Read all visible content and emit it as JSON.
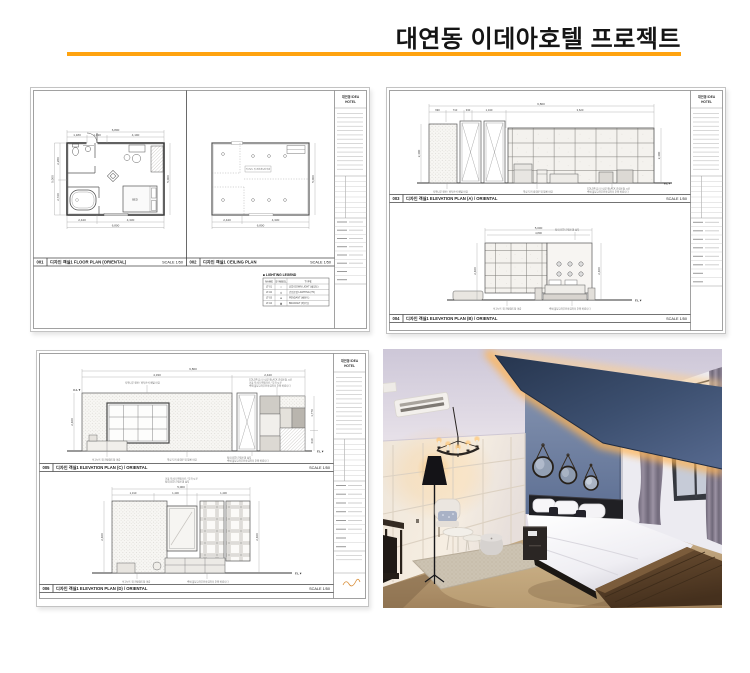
{
  "header": {
    "title": "대연동 이데아호텔 프로젝트",
    "accent_color": "#FFA30F"
  },
  "marks": {
    "fl": "F.L▼",
    "cl": "C.L▼"
  },
  "tb": {
    "p1": "대연동 IDEA",
    "p2": "HOTEL"
  },
  "bars": {
    "b1": {
      "no": "001",
      "label": "디자인 객실1 FLOOR PLAN (ORIENTAL)",
      "scale": "SCALE 1/50"
    },
    "b2": {
      "no": "002",
      "label": "디자인 객실1 CEILING PLAN",
      "scale": "SCALE 1/50"
    },
    "b3": {
      "no": "003",
      "label": "디자인 객실1 ELEVATION PLAN (A) / ORIENTAL",
      "scale": "SCALE 1/50"
    },
    "b4": {
      "no": "004",
      "label": "디자인 객실1 ELEVATION PLAN (B) / ORIENTAL",
      "scale": "SCALE 1/50"
    },
    "b5": {
      "no": "005",
      "label": "디자인 객실1 ELEVATION PLAN (C) / ORIENTAL",
      "scale": "SCALE 1/50"
    },
    "b6": {
      "no": "006",
      "label": "디자인 객실1 ELEVATION PLAN (D) / ORIENTAL",
      "scale": "SCALE 1/50"
    }
  },
  "legend": {
    "title": "■ LIGHTING LEGEND",
    "cols": [
      "NAME",
      "SYMBOL",
      "TYPE"
    ],
    "rows": [
      [
        "LT-01",
        "✧",
        "LED DOWN LIGHT (매입등)"
      ],
      [
        "LT-02",
        "◎",
        "간접조명 LIGHTING (T5)"
      ],
      [
        "LT-03",
        "⊕",
        "PENDANT (펜던트)"
      ],
      [
        "LT-04",
        "▣",
        "BRACKET (벽부등)"
      ]
    ]
  },
  "notes": {
    "n1": "석고보드 위 친환경도장 마감",
    "n2": "자작나무 합판 / 바둑판식 배열 마감",
    "n3": "COLOR 유리 / 내부 BLACK 간접조명 시공",
    "n4": "벽체 몰딩교차부분마감처리 주의 바랍니다",
    "n5": "객실 도어 방화문 위 필름 마감",
    "n6": "침대 LED 간접조명 설치",
    "n7": "거울 모서리 면취가공 / 부착 시공"
  },
  "s1": {
    "fp": {
      "tt": "6,800",
      "t1": "1,180",
      "t2": "1,430",
      "t3": "4,190",
      "b1": "2,440",
      "b2": "4,330",
      "bt": "6,800",
      "l1": "2,280",
      "l2": "2,720",
      "lt": "5,000",
      "rt": "5,000",
      "bed": "BED"
    },
    "cp": {
      "b1": "2,440",
      "b2": "4,330",
      "bt": "6,800",
      "rt": "5,000"
    }
  },
  "s2": {
    "ea": {
      "tt": "6,800",
      "s1": "690",
      "s2": "710",
      "s3": "330",
      "s4": "1,340",
      "s5": "3,620",
      "lh": "2,400",
      "rh": "2,400"
    },
    "eb": {
      "tt": "5,000",
      "t2": "4,800",
      "lh": "2,400",
      "rh": "2,400"
    }
  },
  "s3": {
    "ec": {
      "tt": "6,800",
      "s1": "4,330",
      "s2": "2,440",
      "lh": "2,400",
      "r1": "1,770",
      "r2": "630"
    },
    "ed": {
      "tt": "5,000",
      "s1": "1,310",
      "s2": "1,430",
      "s3": "1,430",
      "lh": "2,400",
      "rh": "2,400"
    }
  }
}
